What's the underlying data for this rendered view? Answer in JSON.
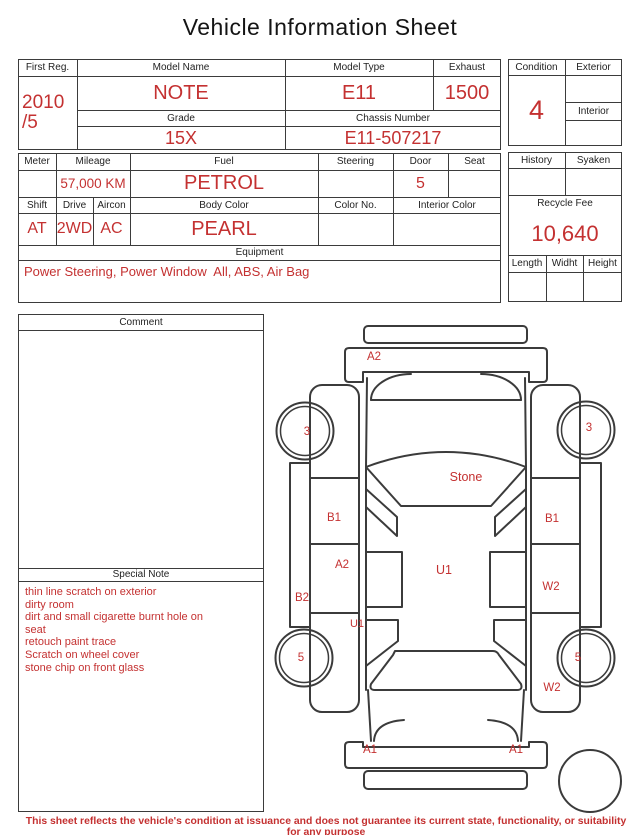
{
  "title": "Vehicle Information Sheet",
  "colors": {
    "accent": "#c43131",
    "line": "#3b3b3b"
  },
  "table1": {
    "first_reg_label": "First Reg.",
    "first_reg_value": "2010\n/5",
    "model_name_label": "Model Name",
    "model_name_value": "NOTE",
    "model_type_label": "Model Type",
    "model_type_value": "E11",
    "exhaust_label": "Exhaust",
    "exhaust_value": "1500",
    "grade_label": "Grade",
    "grade_value": "15X",
    "chassis_label": "Chassis Number",
    "chassis_value": "E11-507217"
  },
  "condition_panel": {
    "condition_label": "Condition",
    "condition_value": "4",
    "exterior_label": "Exterior",
    "interior_label": "Interior"
  },
  "table2": {
    "meter_label": "Meter",
    "mileage_label": "Mileage",
    "mileage_value": "57,000 KM",
    "fuel_label": "Fuel",
    "fuel_value": "PETROL",
    "steering_label": "Steering",
    "door_label": "Door",
    "door_value": "5",
    "seat_label": "Seat",
    "shift_label": "Shift",
    "shift_value": "AT",
    "drive_label": "Drive",
    "drive_value": "2WD",
    "aircon_label": "Aircon",
    "aircon_value": "AC",
    "body_color_label": "Body Color",
    "body_color_value": "PEARL",
    "color_no_label": "Color No.",
    "interior_color_label": "Interior Color",
    "equipment_label": "Equipment",
    "equipment_value": "Power Steering, Power Window  All, ABS, Air Bag"
  },
  "fee_panel": {
    "history_label": "History",
    "syaken_label": "Syaken",
    "recycle_fee_label": "Recycle Fee",
    "recycle_fee_value": "10,640",
    "length_label": "Length",
    "width_label": "Widht",
    "height_label": "Height"
  },
  "comment": {
    "header": "Comment"
  },
  "special_note": {
    "header": "Special Note",
    "body": "thin line scratch on exterior\ndirty room\ndirt and small cigarette burnt hole on\n seat\nretouch paint trace\nScratch on wheel cover\nstone chip on front glass"
  },
  "car_diagram": {
    "labels": {
      "front_bumper": "A2",
      "front_wheel_left": "3",
      "front_wheel_right": "3",
      "windshield": "Stone",
      "front_door_left": "B1",
      "front_door_right": "B1",
      "rear_door_left": "A2",
      "rocker_left": "B2",
      "roof": "U1",
      "roof_left_edge": "U1",
      "rear_door_right": "W2",
      "rear_wheel_left": "5",
      "rear_wheel_right": "5",
      "rear_quarter_right": "W2",
      "rear_bumper_left": "A1",
      "rear_bumper_right": "A1"
    }
  },
  "footer": "This sheet reflects the vehicle's condition at issuance and does not guarantee its current state, functionality, or suitability for any purpose"
}
